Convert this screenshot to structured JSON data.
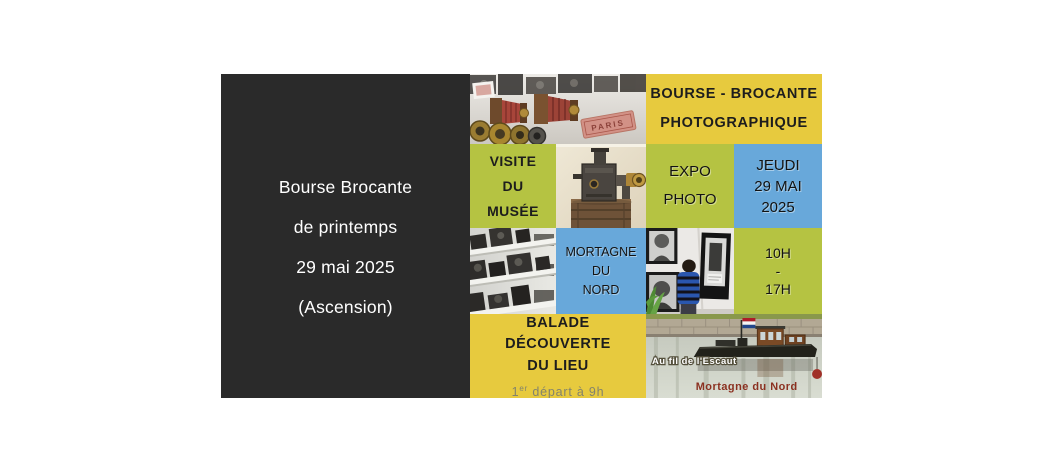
{
  "poster": {
    "left_panel": {
      "lines": [
        "Bourse Brocante",
        "de printemps",
        "29 mai 2025",
        "(Ascension)"
      ],
      "bg_color": "#2a2a2a",
      "text_color": "#ffffff"
    },
    "grid": {
      "title": {
        "line1": "BOURSE - BROCANTE",
        "line2": "PHOTOGRAPHIQUE"
      },
      "visite": {
        "line1": "VISITE",
        "line2": "DU",
        "line3": "MUSÉE"
      },
      "expo": {
        "line1": "EXPO",
        "line2": "PHOTO"
      },
      "date": {
        "line1": "JEUDI",
        "line2": "29 MAI",
        "line3": "2025"
      },
      "location": {
        "line1": "MORTAGNE",
        "line2": "DU",
        "line3": "NORD"
      },
      "hours": {
        "line1": "10H",
        "line2": "-",
        "line3": "17H"
      },
      "balade": {
        "line1": "BALADE",
        "line2": "DÉCOUVERTE",
        "line3": "DU LIEU",
        "sub_num": "1",
        "sub_sup": "er",
        "sub_rest": " départ à 9h"
      }
    },
    "photos": {
      "cameras": {
        "label": "PARIS"
      },
      "boat": {
        "caption_river": "Au fil de l'Escaut",
        "caption_town": "Mortagne du Nord"
      }
    },
    "colors": {
      "panel": "#2a2a2a",
      "yellow": "#e7ca3e",
      "green": "#b5c342",
      "blue": "#68a8da",
      "caption_town_color": "#8b3020"
    }
  }
}
